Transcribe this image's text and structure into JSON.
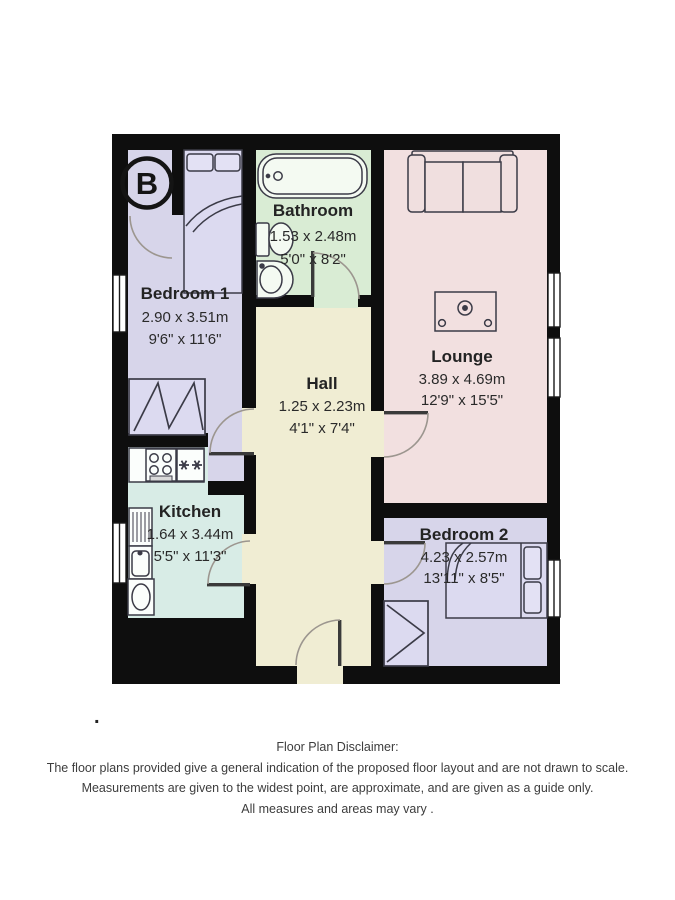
{
  "logo": {
    "letter": "B"
  },
  "rooms": {
    "bedroom1": {
      "name": "Bedroom 1",
      "metric": "2.90 x 3.51m",
      "imperial": "9'6\" x 11'6\""
    },
    "bathroom": {
      "name": "Bathroom",
      "metric": "1.53 x 2.48m",
      "imperial": "5'0\" x 8'2\""
    },
    "hall": {
      "name": "Hall",
      "metric": "1.25 x 2.23m",
      "imperial": "4'1\" x 7'4\""
    },
    "lounge": {
      "name": "Lounge",
      "metric": "3.89 x 4.69m",
      "imperial": "12'9\" x 15'5\""
    },
    "kitchen": {
      "name": "Kitchen",
      "metric": "1.64 x 3.44m",
      "imperial": "5'5\" x 11'3\""
    },
    "bedroom2": {
      "name": "Bedroom 2",
      "metric": "4.23 x 2.57m",
      "imperial": "13'11\" x 8'5\""
    }
  },
  "disclaimer": {
    "title": "Floor Plan Disclaimer:",
    "line1": "The floor plans provided give a general indication of the proposed floor layout and are not drawn to scale.",
    "line2": "Measurements are given to the widest point, are approximate, and are given as a guide only.",
    "line3": "All measures and areas may vary ."
  },
  "stray_mark": ".",
  "colors": {
    "wall": "#0e0e0e",
    "bedroom": "#d7d5ea",
    "bathroom": "#d9ecd4",
    "hall": "#f0edd3",
    "lounge": "#f2e0e0",
    "kitchen": "#d8ece6",
    "window": "#ffffff",
    "door_arc": "#9c968f",
    "furniture_outline": "#3b3b47"
  }
}
